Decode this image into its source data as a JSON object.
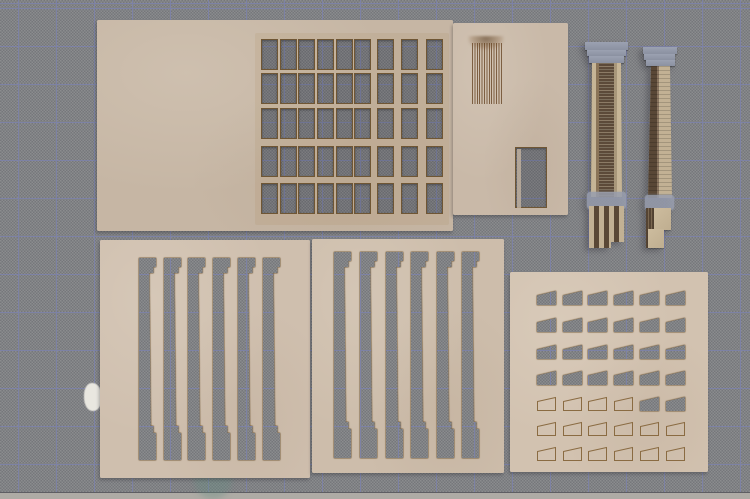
{
  "meta": {
    "description": "Photograph of laser-cut tan cardboard architectural model-kit parts (window-grid facade sheet, hatched panel sheet, two assembled fluted columns, two pilaster cut-out sheets, corbel/trapezoid cut-out sheet) laid on a gray self-healing cutting mat",
    "photo_width": 750,
    "photo_height": 499
  },
  "palette": {
    "mat": "#8b8c8e",
    "mat_grid_line": "#7d82a5",
    "table": "#aeaba5",
    "paint_spot": "#e9e7e0",
    "stain": "rgba(100,140,130,0.35)",
    "cut_edge": "#6f5634",
    "score_line": "#8a6b42",
    "hatch_line": "#7d5f42",
    "cap_gray": "#8b91a1",
    "glue_gray": "#989eae",
    "column_dark": "#5c4a39",
    "column_tan": "#c6b596"
  },
  "mat": {
    "grid_pitch_px": 38,
    "grid_offset_x": 18,
    "grid_offset_y": 8,
    "mat_bottom_edge_y": 492
  },
  "mat_marks": {
    "paint_spot": {
      "x": 84,
      "y": 383,
      "w": 18,
      "h": 28
    },
    "stain": {
      "x": 194,
      "y": 461,
      "w": 38,
      "h": 38
    }
  },
  "pieces": [
    {
      "id": "sheet-window-grid",
      "type": "sheet",
      "x": 97,
      "y": 20,
      "w": 356,
      "h": 211,
      "color": "#c6b6a4",
      "scorch": {
        "x": 158,
        "y": 13,
        "w": 194,
        "h": 192
      },
      "window_grid": {
        "row_tops": [
          19,
          53,
          88,
          126,
          163
        ],
        "window_h": 31,
        "groups": [
          {
            "lefts": [
              164,
              183,
              201,
              220,
              239,
              257
            ],
            "window_w": 16.5
          },
          {
            "lefts": [
              280,
              304,
              329
            ],
            "window_w": 17
          }
        ]
      }
    },
    {
      "id": "sheet-hatch-panel",
      "type": "sheet",
      "x": 453,
      "y": 23,
      "w": 115,
      "h": 192,
      "color": "#c9b9a8",
      "hatch": {
        "x": 19,
        "y": 20,
        "w": 30,
        "h": 61
      },
      "singe": {
        "x": 15,
        "y": 13,
        "w": 36,
        "h": 14
      },
      "door_cutout": {
        "x": 62,
        "y": 124,
        "w": 32,
        "h": 61
      }
    },
    {
      "id": "column-assembled-left",
      "type": "column",
      "style": "front",
      "x": 585,
      "y": 42,
      "w": 43,
      "h": 206
    },
    {
      "id": "column-assembled-right",
      "type": "column",
      "style": "side",
      "x": 643,
      "y": 47,
      "w": 34,
      "h": 201
    },
    {
      "id": "sheet-pilasters-left",
      "type": "sheet",
      "x": 100,
      "y": 240,
      "w": 210,
      "h": 238,
      "color": "#cfbfae",
      "pilaster_cutouts": {
        "top": 18,
        "lefts": [
          39,
          64,
          88,
          113,
          138,
          163
        ],
        "w": 17,
        "h": 202,
        "base_y": 168
      }
    },
    {
      "id": "sheet-pilasters-right",
      "type": "sheet",
      "x": 312,
      "y": 239,
      "w": 192,
      "h": 234,
      "color": "#cdbdab",
      "pilaster_cutouts": {
        "top": 13,
        "lefts": [
          22,
          48,
          74,
          99,
          125,
          150
        ],
        "w": 17,
        "h": 206,
        "base_y": 170
      }
    },
    {
      "id": "sheet-corbel-grid",
      "type": "sheet",
      "x": 510,
      "y": 272,
      "w": 198,
      "h": 200,
      "color": "#d2c2b0",
      "trapezoid_grid": {
        "col_lefts": [
          27,
          53,
          78,
          104,
          130,
          156
        ],
        "row_tops": [
          19,
          46,
          73,
          99,
          125,
          150,
          175
        ],
        "cell_w": 19,
        "cell_h": 14,
        "punched": [
          [
            true,
            true,
            true,
            true,
            true,
            true
          ],
          [
            true,
            true,
            true,
            true,
            true,
            true
          ],
          [
            true,
            true,
            true,
            true,
            true,
            true
          ],
          [
            true,
            true,
            true,
            true,
            true,
            true
          ],
          [
            false,
            false,
            false,
            false,
            true,
            true
          ],
          [
            false,
            false,
            false,
            false,
            false,
            false
          ],
          [
            false,
            false,
            false,
            false,
            false,
            false
          ]
        ]
      }
    }
  ]
}
